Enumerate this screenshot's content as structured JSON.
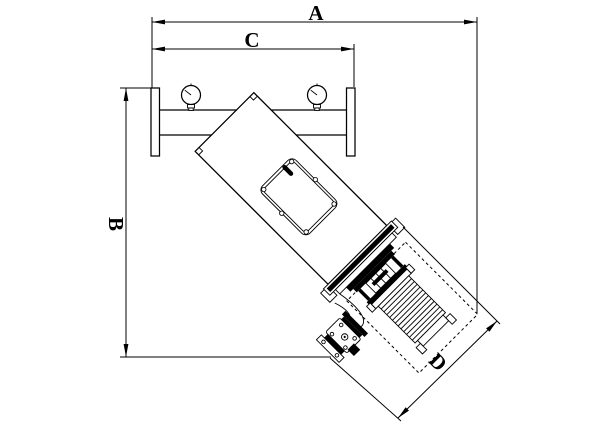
{
  "figure": {
    "type": "technical-dimension-drawing",
    "subject": "inclined-self-cleaning-filter",
    "background_color": "#ffffff",
    "line_color": "#000000"
  },
  "dimensions": {
    "a": {
      "label": "A"
    },
    "b": {
      "label": "B"
    },
    "c": {
      "label": "C"
    },
    "d": {
      "label": "D"
    }
  }
}
